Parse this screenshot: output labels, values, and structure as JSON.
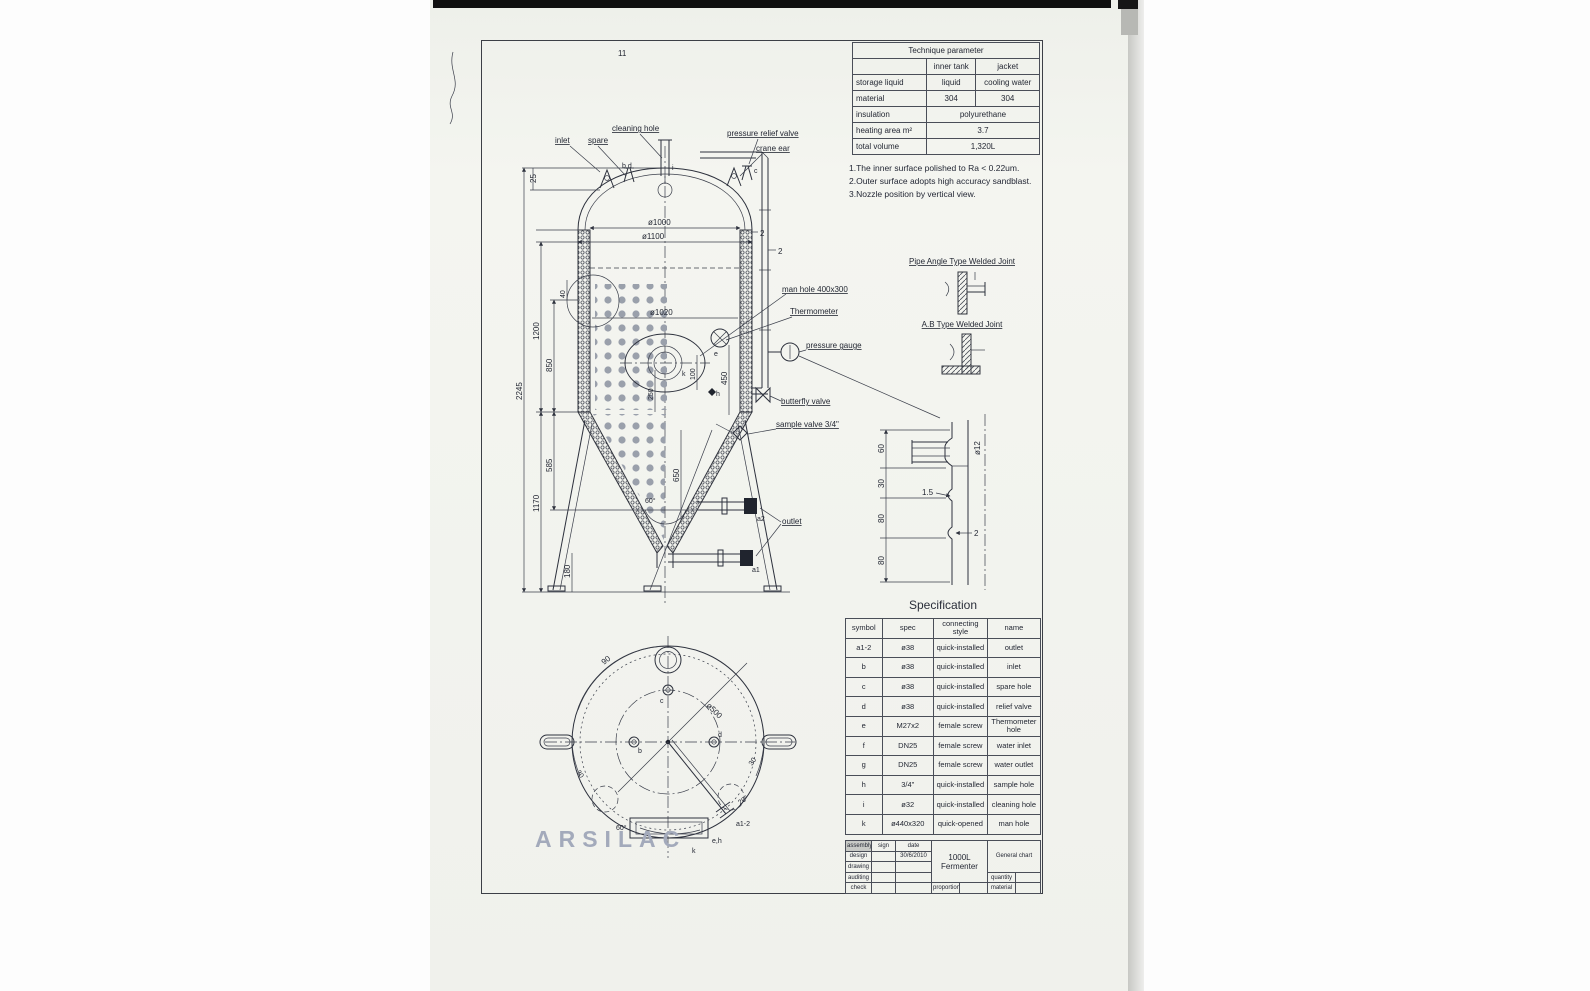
{
  "brand": {
    "watermark": "ARSILAC"
  },
  "artifacts": {
    "pencil": "11"
  },
  "tech": {
    "title": "Technique parameter",
    "col1": "inner tank",
    "col2": "jacket",
    "rows": [
      [
        "storage liquid",
        "liquid",
        "cooling water"
      ],
      [
        "material",
        "304",
        "304"
      ],
      [
        "insulation",
        "polyurethane"
      ],
      [
        "heating area m²",
        "3.7"
      ],
      [
        "total volume",
        "1,320L"
      ]
    ]
  },
  "notes": [
    "1.The inner surface polished to Ra < 0.22um.",
    "2.Outer surface adopts high accuracy sandblast.",
    "3.Nozzle position by vertical view."
  ],
  "joints": {
    "pipe_angle": "Pipe Angle Type Welded Joint",
    "ab": "A.B Type Welded Joint"
  },
  "spec": {
    "title": "Specification",
    "headers": [
      "symbol",
      "spec",
      "connecting style",
      "name"
    ],
    "rows": [
      [
        "a1-2",
        "ø38",
        "quick-installed",
        "outlet"
      ],
      [
        "b",
        "ø38",
        "quick-installed",
        "inlet"
      ],
      [
        "c",
        "ø38",
        "quick-installed",
        "spare hole"
      ],
      [
        "d",
        "ø38",
        "quick-installed",
        "relief valve"
      ],
      [
        "e",
        "M27x2",
        "female screw",
        "Thermometer hole"
      ],
      [
        "f",
        "DN25",
        "female screw",
        "water inlet"
      ],
      [
        "g",
        "DN25",
        "female screw",
        "water outlet"
      ],
      [
        "h",
        "3/4\"",
        "quick-installed",
        "sample hole"
      ],
      [
        "i",
        "ø32",
        "quick-installed",
        "cleaning hole"
      ],
      [
        "k",
        "ø440x320",
        "quick-opened",
        "man hole"
      ]
    ]
  },
  "title_block": {
    "row_labels": [
      "assembly",
      "design",
      "drawing",
      "auditing",
      "check"
    ],
    "sign": "sign",
    "date": "date",
    "design_date": "30/6/2010",
    "product_l1": "1000L",
    "product_l2": "Fermenter",
    "doc_type": "General chart",
    "quantity": "quantity",
    "material": "material",
    "proportion": "proportion"
  },
  "drawing": {
    "top_labels": {
      "inlet": "inlet",
      "spare": "spare",
      "cleaning_hole": "cleaning hole",
      "prv": "pressure relief valve",
      "crane_ear": "crane ear"
    },
    "marks": {
      "bd": "b,d",
      "i": "i",
      "c": "c",
      "e": "e",
      "k": "k",
      "h": "h",
      "a2": "a2",
      "a1": "a1"
    },
    "mid_labels": {
      "man_hole": "man hole 400x300",
      "thermometer": "Thermometer",
      "pressure_gauge": "pressure gauge",
      "butterfly": "butterfly valve",
      "sample": "sample valve 3/4\"",
      "outlet": "outlet"
    },
    "dims": {
      "d25": "25",
      "d1200": "1200",
      "d850": "850",
      "d2245": "2245",
      "d40": "40",
      "d250": "250",
      "d585": "585",
      "d1170": "1170",
      "d650": "650",
      "d180": "180",
      "d60": "60°",
      "phi1000": "ø1000",
      "phi1100": "ø1100",
      "phi1020": "ø1020",
      "t2a": "2",
      "t2b": "2",
      "d450": "450",
      "d100": "100"
    },
    "detail": {
      "d60": "60",
      "d30": "30",
      "d80a": "80",
      "d80b": "80",
      "phi12": "ø12",
      "d15": "1.5",
      "d2": "2"
    },
    "bottom": {
      "a90": "90",
      "phi500": "ø500",
      "a30l": "30",
      "a30r": "30",
      "a20": "20°",
      "a60": "60°",
      "c": "c",
      "b": "b",
      "d": "d",
      "eh": "e,h",
      "k": "k",
      "a12": "a1-2"
    }
  }
}
